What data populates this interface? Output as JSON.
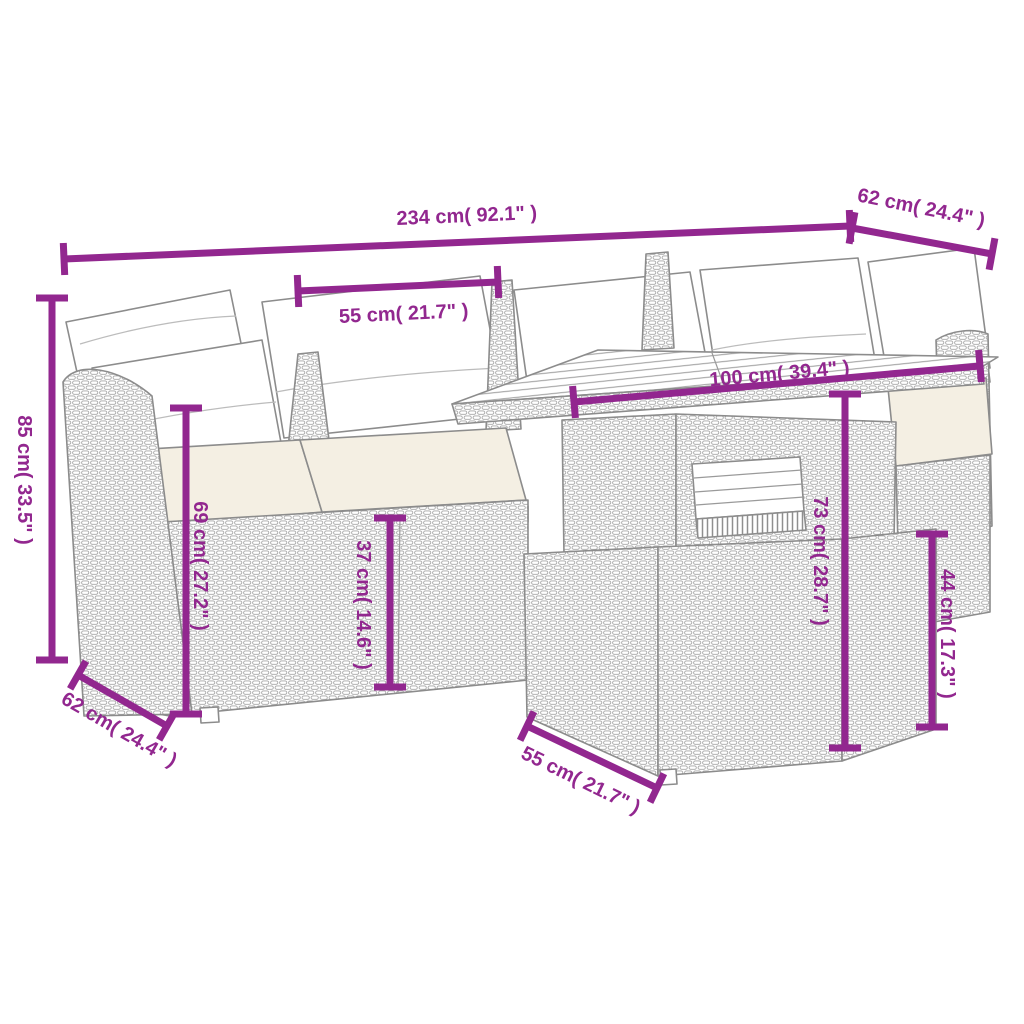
{
  "diagram": {
    "kind": "product-dimension-line-art",
    "product": "poly-rattan-garden-lounge-set-with-cushions-table-and-ottoman"
  },
  "colors": {
    "dimension": "#92278f",
    "line_art": "#8c8c8c",
    "wicker_stroke": "#a6a6a6",
    "cushion_white": "#ffffff",
    "cushion_cream": "#f4efe3",
    "background": "#ffffff"
  },
  "dims": {
    "total_width": "234 cm( 92.1\" )",
    "right_arm_depth": "62 cm( 24.4\" )",
    "seat_width": "55 cm( 21.7\" )",
    "total_height": "85 cm( 33.5\" )",
    "back_height": "69 cm( 27.2\" )",
    "seat_height": "37 cm( 14.6\" )",
    "table_length": "100 cm( 39.4\" )",
    "table_height": "73 cm( 28.7\" )",
    "ottoman_height": "44 cm( 17.3\" )",
    "left_arm_depth": "62 cm( 24.4\" )",
    "ottoman_width": "55 cm( 21.7\" )"
  }
}
